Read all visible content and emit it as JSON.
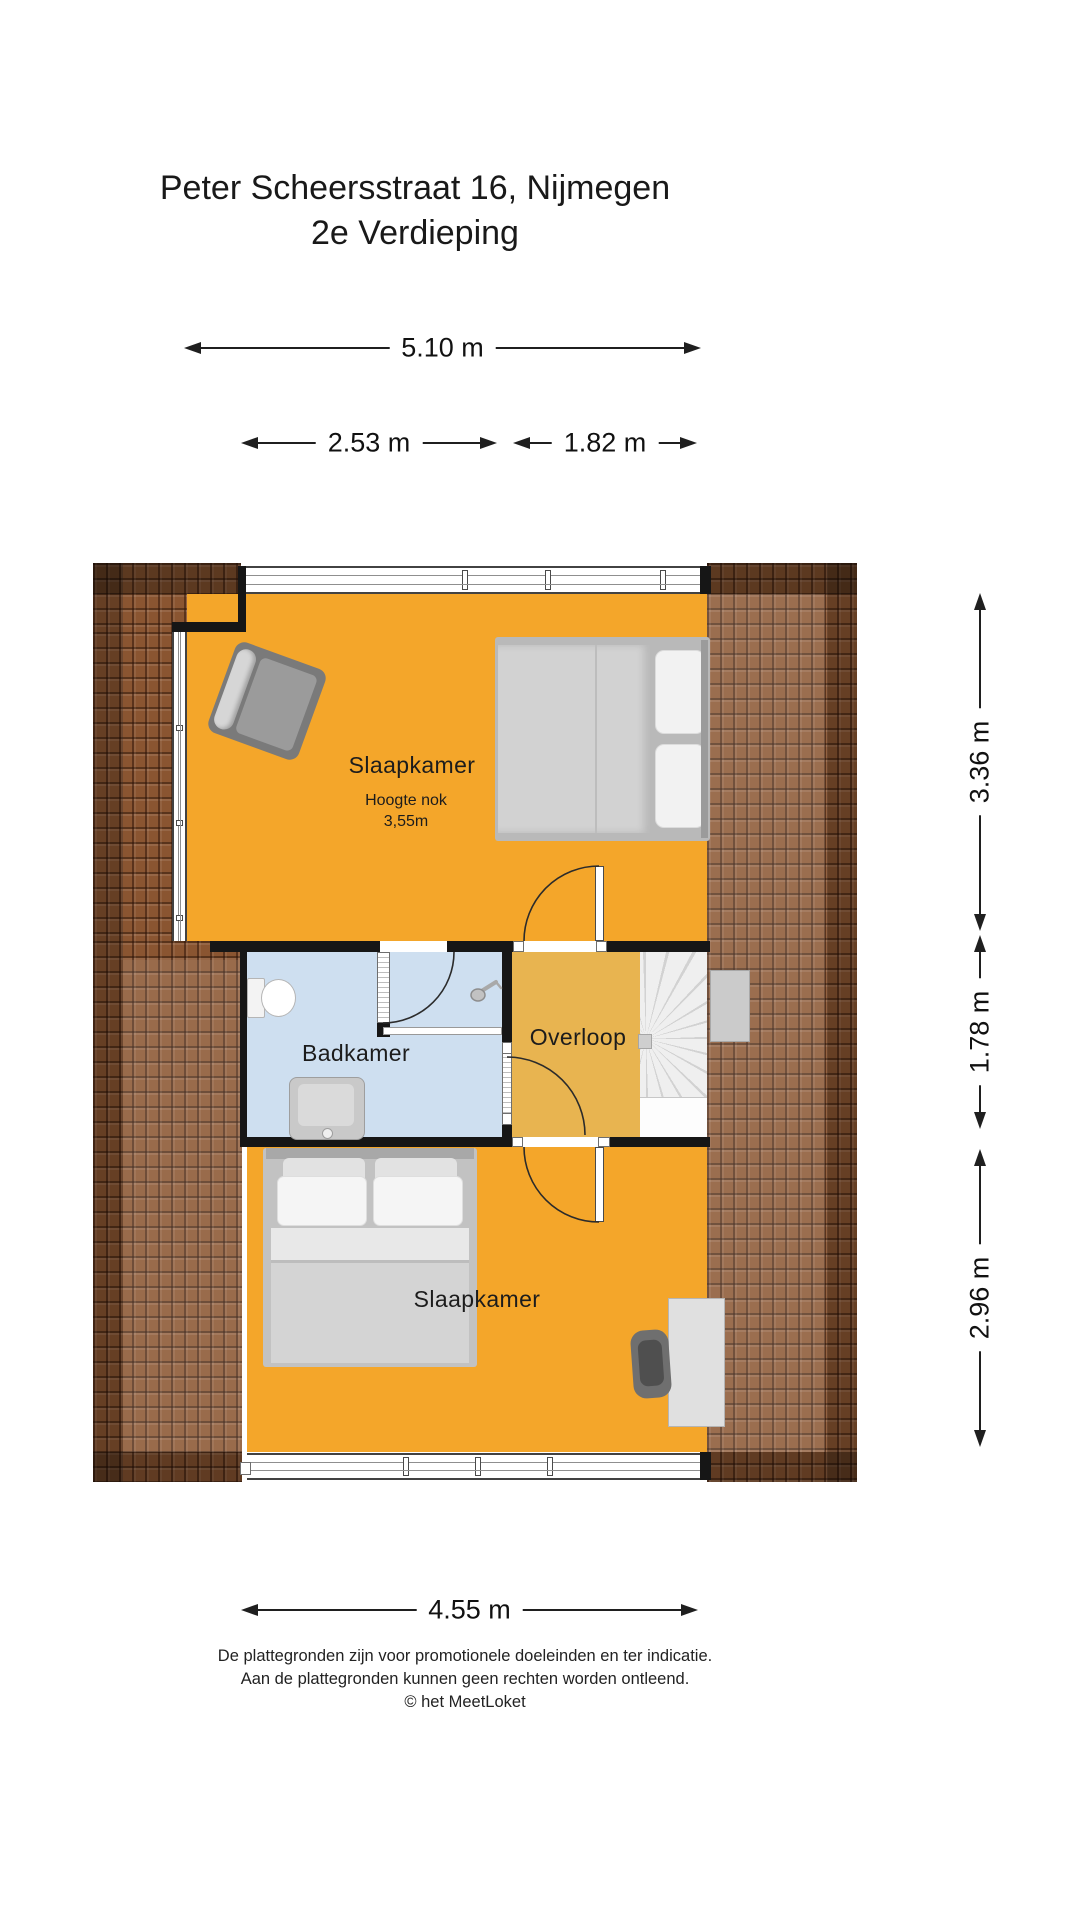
{
  "title": {
    "line1": "Peter Scheersstraat 16, Nijmegen",
    "line2": "2e Verdieping"
  },
  "dimensions": {
    "top_total": "5.10 m",
    "top_left": "2.53 m",
    "top_right": "1.82 m",
    "right_top": "3.36 m",
    "right_middle": "1.78 m",
    "right_bottom": "2.96 m",
    "bottom_total": "4.55 m"
  },
  "rooms": {
    "bedroom_top": {
      "label": "Slaapkamer",
      "note_line1": "Hoogte nok",
      "note_line2": "3,55m"
    },
    "bathroom": {
      "label": "Badkamer"
    },
    "landing": {
      "label": "Overloop"
    },
    "bedroom_bottom": {
      "label": "Slaapkamer"
    }
  },
  "furniture_icons": [
    "armchair-icon",
    "double-bed-icon",
    "toilet-icon",
    "washbasin-icon",
    "shower-icon",
    "stairs-icon",
    "desk-icon",
    "office-chair-icon"
  ],
  "footer": {
    "line1": "De plattegronden zijn voor promotionele doeleinden en ter indicatie.",
    "line2": "Aan de plattegronden kunnen geen rechten worden ontleend.",
    "line3": "© het MeetLoket"
  },
  "colors": {
    "room_orange": "#F4A62A",
    "landing_amber": "#E8B450",
    "bathroom_blue": "#CEDFF0",
    "roof_brown": "#8A5531",
    "wall_black": "#161616"
  }
}
